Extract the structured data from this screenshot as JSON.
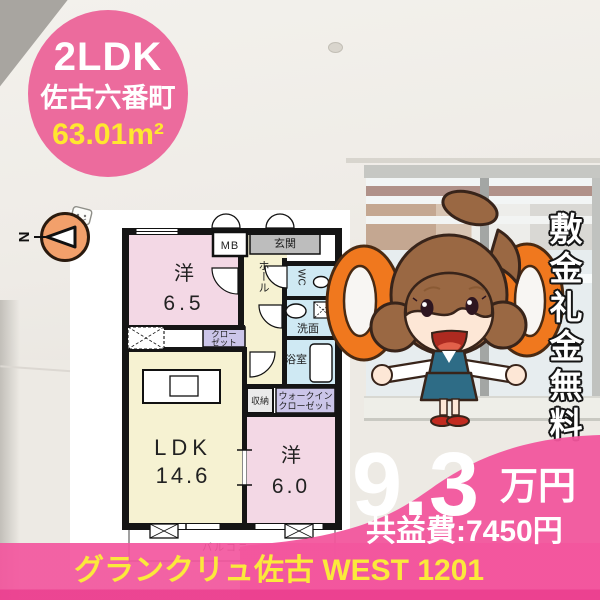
{
  "badge": {
    "layout": "2LDK",
    "location": "佐古六番町",
    "area": "63.01m²"
  },
  "compass": {
    "north": "N"
  },
  "plan": {
    "mb": "MB",
    "entrance": "玄関",
    "hall": "ホール",
    "wc": "WC",
    "washroom": "洗面",
    "bath": "浴室",
    "closet_line1": "クロー",
    "closet_line2": "ゼット",
    "room1_type": "洋",
    "room1_size": "6.5",
    "ldk_label": "LDK",
    "ldk_size": "14.6",
    "storage": "収納",
    "wic_line1": "ウォークイン",
    "wic_line2": "クローゼット",
    "room2_type": "洋",
    "room2_size": "6.0",
    "balcony": "バルコニー"
  },
  "promo": {
    "vertical_text": "敷金礼金無料"
  },
  "price": {
    "rent": "9.3",
    "unit": "万円",
    "maintenance": "共益費:7450円"
  },
  "footer": {
    "building": "グランクリュ佐古 WEST 1201"
  },
  "colors": {
    "accent_pink": "#F2559C",
    "badge_pink": "#EC6B9D",
    "highlight_yellow": "#FFE72F",
    "zero_orange": "#F0781E",
    "plan_room_pink": "#F3D8E5",
    "plan_room_cream": "#F6F2D2",
    "plan_water_blue": "#CFE9F3",
    "plan_closet_purple": "#CBC5E9",
    "plan_entrance_gray": "#BDBDBD"
  }
}
